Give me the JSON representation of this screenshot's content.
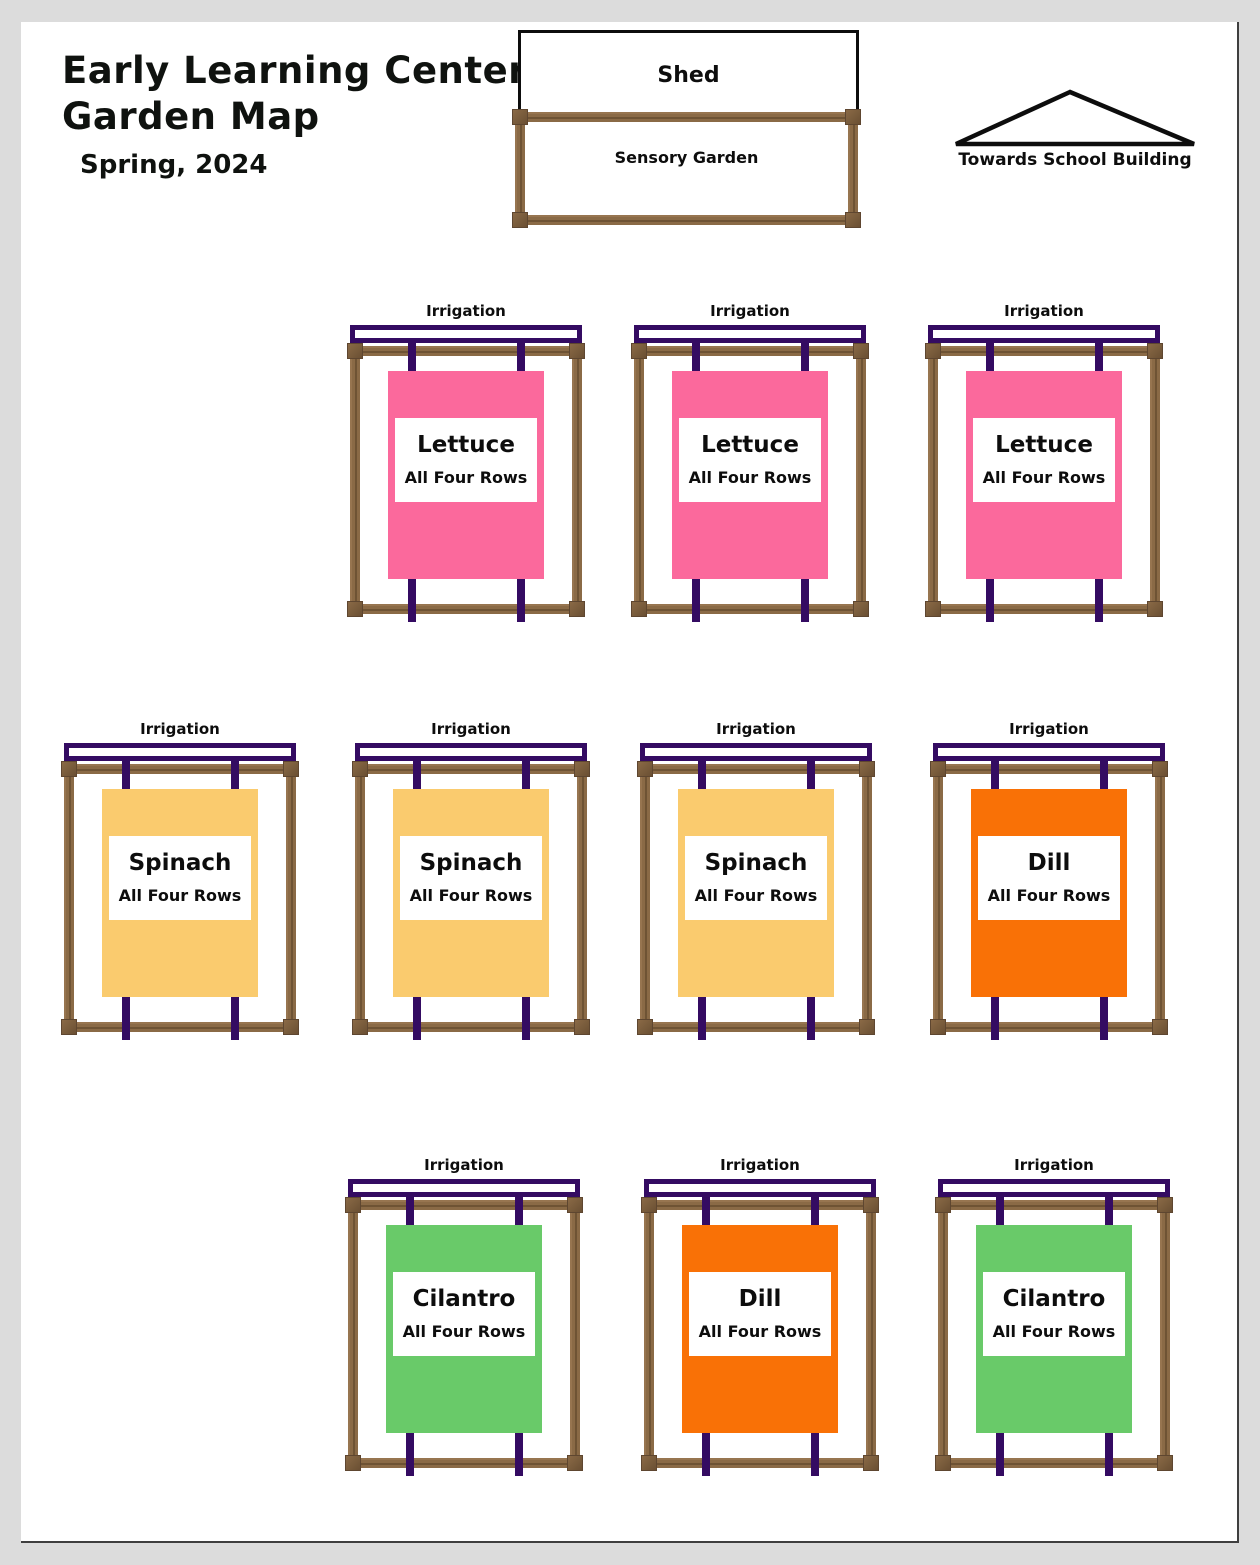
{
  "header": {
    "title_line1": "Early Learning Center",
    "title_line2": "Garden Map",
    "subtitle": "Spring, 2024"
  },
  "landmarks": {
    "shed": {
      "label": "Shed"
    },
    "sensory_garden": {
      "label": "Sensory Garden"
    },
    "direction": {
      "label": "Towards School Building"
    }
  },
  "palette": {
    "irrigation_purple": "#340B62",
    "wood_brown": "#8A6A46",
    "canvas_background": "#DCDCDC",
    "page_background": "#FFFFFF",
    "lettuce_pink": "#FB699C",
    "spinach_yellow": "#FACB6E",
    "dill_orange": "#F97106",
    "cilantro_green": "#69CA69"
  },
  "beds": [
    {
      "row": 1,
      "position": 1,
      "irrigation_label": "Irrigation",
      "crop": "Lettuce",
      "note": "All Four Rows",
      "color": "#FB699C"
    },
    {
      "row": 1,
      "position": 2,
      "irrigation_label": "Irrigation",
      "crop": "Lettuce",
      "note": "All Four Rows",
      "color": "#FB699C"
    },
    {
      "row": 1,
      "position": 3,
      "irrigation_label": "Irrigation",
      "crop": "Lettuce",
      "note": "All Four Rows",
      "color": "#FB699C"
    },
    {
      "row": 2,
      "position": 1,
      "irrigation_label": "Irrigation",
      "crop": "Spinach",
      "note": "All Four Rows",
      "color": "#FACB6E"
    },
    {
      "row": 2,
      "position": 2,
      "irrigation_label": "Irrigation",
      "crop": "Spinach",
      "note": "All Four Rows",
      "color": "#FACB6E"
    },
    {
      "row": 2,
      "position": 3,
      "irrigation_label": "Irrigation",
      "crop": "Spinach",
      "note": "All Four Rows",
      "color": "#FACB6E"
    },
    {
      "row": 2,
      "position": 4,
      "irrigation_label": "Irrigation",
      "crop": "Dill",
      "note": "All Four Rows",
      "color": "#F97106"
    },
    {
      "row": 3,
      "position": 1,
      "irrigation_label": "Irrigation",
      "crop": "Cilantro",
      "note": "All Four Rows",
      "color": "#69CA69"
    },
    {
      "row": 3,
      "position": 2,
      "irrigation_label": "Irrigation",
      "crop": "Dill",
      "note": "All Four Rows",
      "color": "#F97106"
    },
    {
      "row": 3,
      "position": 3,
      "irrigation_label": "Irrigation",
      "crop": "Cilantro",
      "note": "All Four Rows",
      "color": "#69CA69"
    }
  ]
}
